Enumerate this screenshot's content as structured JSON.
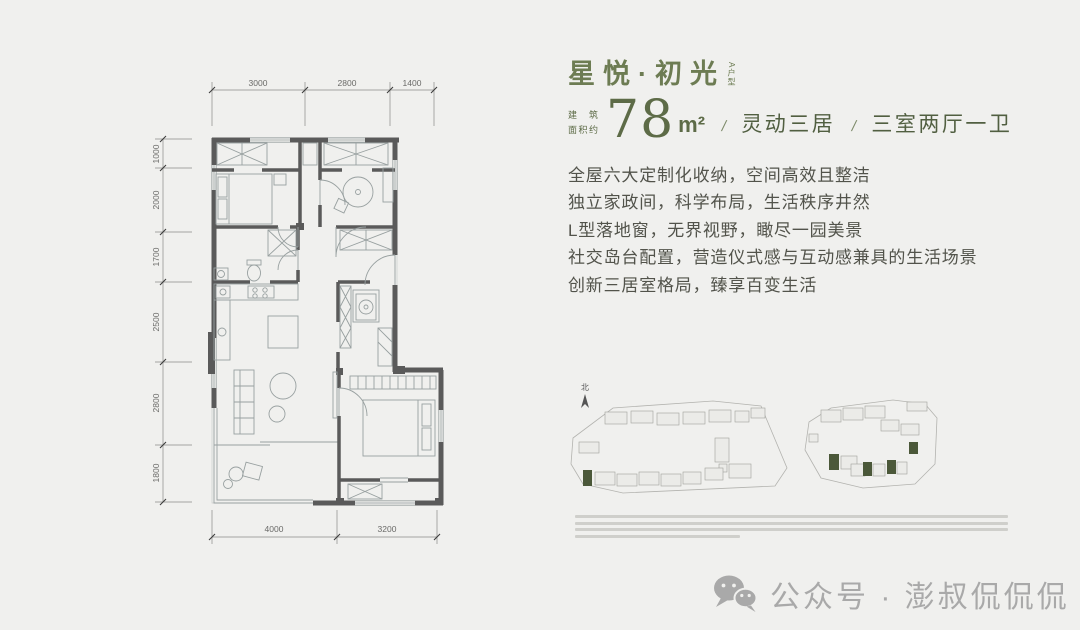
{
  "header": {
    "title": "星悦·初光",
    "tag": "A户型",
    "area_label_1": "建筑",
    "area_label_2": "面积约",
    "area_value": "78",
    "area_unit": "m²",
    "slash": "/",
    "spec1": "灵动三居",
    "spec2": "三室两厅一卫"
  },
  "features": [
    "全屋六大定制化收纳，空间高效且整洁",
    "独立家政间，科学布局，生活秩序井然",
    "L型落地窗，无界视野，瞰尽一园美景",
    "社交岛台配置，营造仪式感与互动感兼具的生活场景",
    "创新三居室格局，臻享百变生活"
  ],
  "floorplan": {
    "dims_top": [
      "3000",
      "2800",
      "1400"
    ],
    "dims_left": [
      "1000",
      "2000",
      "1700",
      "2500",
      "2800",
      "1800"
    ],
    "dims_bottom": [
      "4000",
      "3200"
    ]
  },
  "siteplan": {
    "north": "北"
  },
  "watermark": {
    "label": "公众号 · 澎叔侃侃侃"
  },
  "colors": {
    "background": "#f0f0ee",
    "title_green": "#6d7c53",
    "accent_green_dark": "#515f41",
    "body_text": "#52534b",
    "wall_gray": "#5a5a5a",
    "plan_line": "#98a0a0",
    "dim_gray": "#6a6a68",
    "site_building_highlight": "#4b5839",
    "watermark_gray": "#a9a9a9"
  }
}
